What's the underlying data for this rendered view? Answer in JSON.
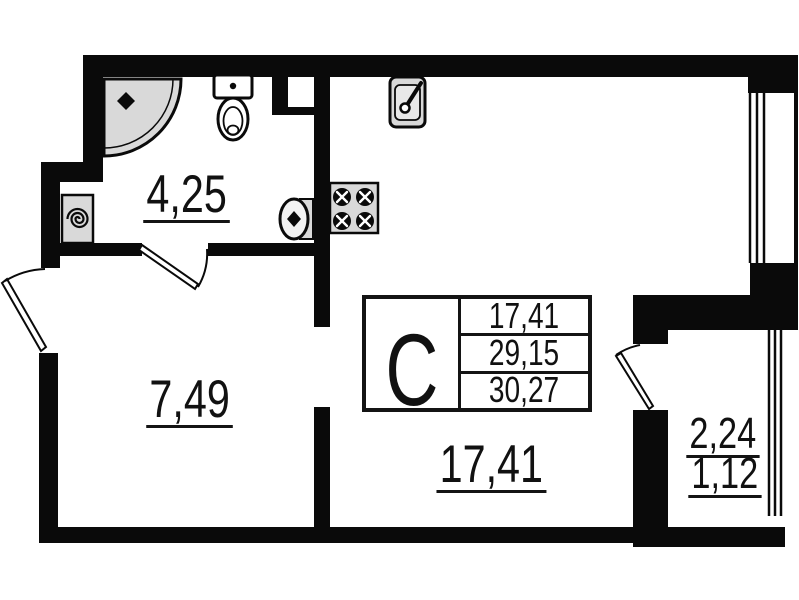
{
  "plan": {
    "background": "#ffffff",
    "wall_color": "#0a0a0a",
    "fixture_fill": "#d9d9d9",
    "unit_table": {
      "type_letter": "С",
      "values": [
        "17,41",
        "29,15",
        "30,27"
      ]
    },
    "rooms": {
      "bathroom": {
        "area": "4,25"
      },
      "hall": {
        "area": "7,49"
      },
      "main": {
        "area": "17,41"
      },
      "balcony": {
        "area": "2,24",
        "area_with_factor": "1,12"
      }
    },
    "fixtures": [
      "shower",
      "toilet",
      "washing-machine",
      "bathroom-sink",
      "stove",
      "kitchen-sink"
    ],
    "openings": [
      "entrance-door",
      "bathroom-door",
      "balcony-door",
      "window-main",
      "window-balcony"
    ]
  }
}
